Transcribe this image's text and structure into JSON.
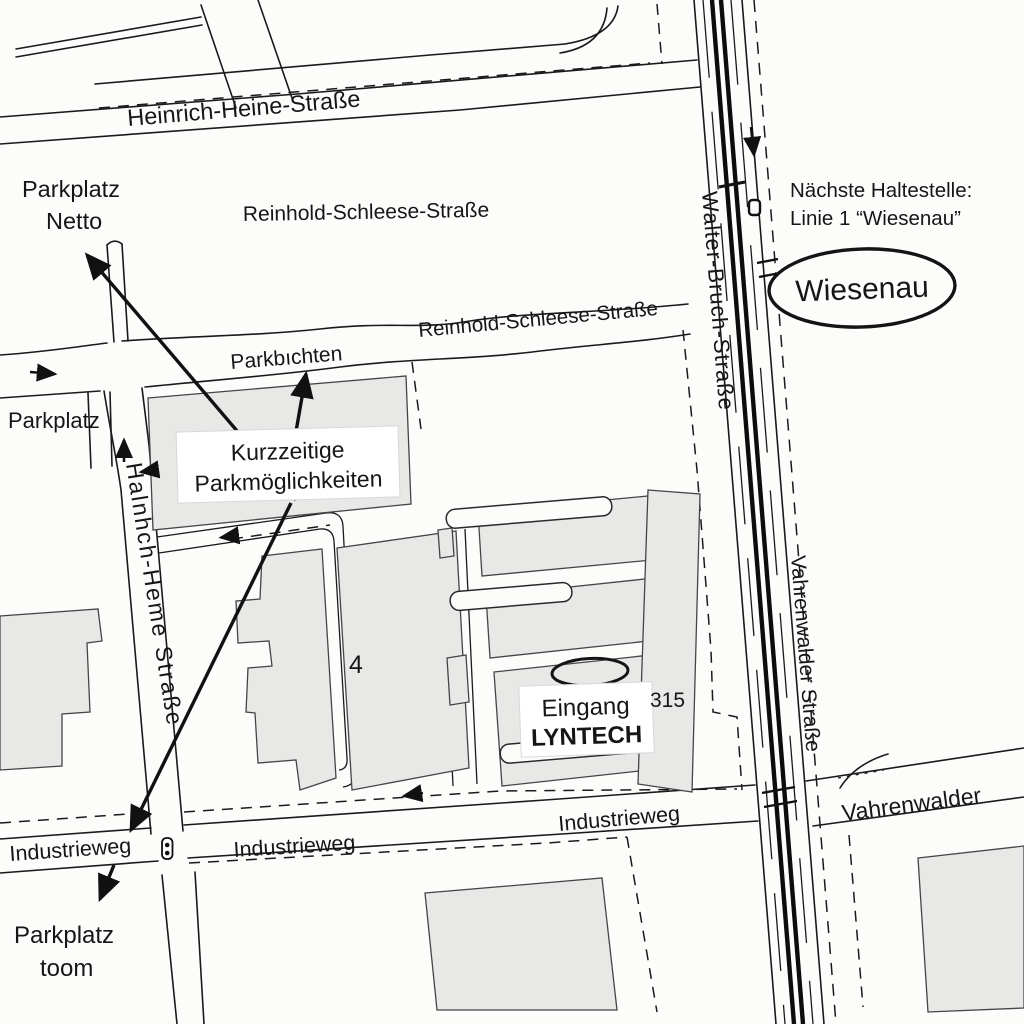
{
  "map": {
    "streets": {
      "heinrich_heine": "Heinrich-Heine-Straße",
      "reinhold_schleese_upper": "Reinhold-Schleese-Straße",
      "reinhold_schleese_lower": "Reinhold-Schleese-Straße",
      "parkbuchten": "Parkbıchten",
      "walter_bruch": "Walter-Bruch-Straße",
      "heinrich_heine_south": "Halnhch-Heme Straße",
      "vahrenwalder_vertical": "Vahrenwalder Straße",
      "industrieweg_west": "Industrieweg",
      "industrieweg_center": "Industrieweg",
      "industrieweg_east": "Industrieweg",
      "vahrenwalder_horizontal": "Vahrenwalder"
    },
    "parking": {
      "netto_line1": "Parkplatz",
      "netto_line2": "Netto",
      "west": "Parkplatz",
      "kurzzeitig_line1": "Kurzzeitige",
      "kurzzeitig_line2": "Parkmöglichkeiten",
      "toom_line1": "Parkplatz",
      "toom_line2": "toom"
    },
    "entrance": {
      "line1": "Eingang",
      "line2": "LYNTECH"
    },
    "buildings": {
      "number_4": "4",
      "number_315": "315"
    },
    "transit": {
      "next_stop_line1": "Nächste Haltestelle:",
      "next_stop_line2": "Linie 1 “Wiesenau”",
      "stop_name": "Wiesenau"
    },
    "colors": {
      "background": "#fcfcfb",
      "line": "#1a1a1a",
      "building_fill": "#e8e8e7",
      "building_stroke": "#454545",
      "label_text": "#161616",
      "label_box": "#ffffff"
    }
  }
}
